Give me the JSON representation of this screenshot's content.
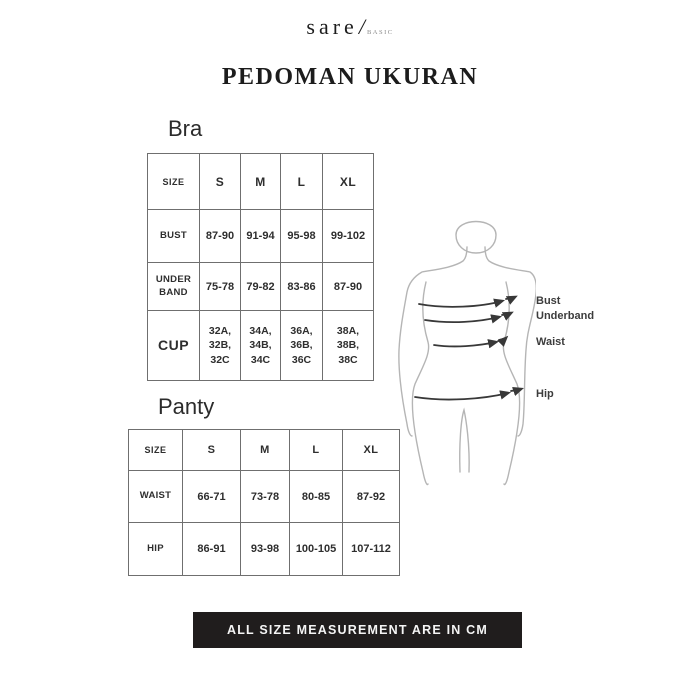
{
  "brand": {
    "name": "sare",
    "slash": "/",
    "sub": "BASIC"
  },
  "page": {
    "title": "PEDOMAN UKURAN"
  },
  "bra": {
    "heading": "Bra",
    "columns": [
      "SIZE",
      "S",
      "M",
      "L",
      "XL"
    ],
    "rows": [
      {
        "label": "BUST",
        "values": [
          "87-90",
          "91-94",
          "95-98",
          "99-102"
        ]
      },
      {
        "label": "UNDER\nBAND",
        "values": [
          "75-78",
          "79-82",
          "83-86",
          "87-90"
        ]
      },
      {
        "label": "CUP",
        "values": [
          "32A,\n32B,\n32C",
          "34A,\n34B,\n34C",
          "36A,\n36B,\n36C",
          "38A,\n38B,\n38C"
        ]
      }
    ]
  },
  "panty": {
    "heading": "Panty",
    "columns": [
      "SIZE",
      "S",
      "M",
      "L",
      "XL"
    ],
    "rows": [
      {
        "label": "WAIST",
        "values": [
          "66-71",
          "73-78",
          "80-85",
          "87-92"
        ]
      },
      {
        "label": "HIP",
        "values": [
          "86-91",
          "93-98",
          "100-105",
          "107-112"
        ]
      }
    ]
  },
  "diagram": {
    "labels": {
      "bust": "Bust",
      "underband": "Underband",
      "waist": "Waist",
      "hip": "Hip"
    }
  },
  "footer": {
    "note": "ALL SIZE MEASUREMENT ARE IN CM"
  },
  "colors": {
    "footer_bg": "#201d1d",
    "text": "#2e2e2e",
    "table_border": "#6f6f6f",
    "figure_outline": "#b5b5b5",
    "arrow": "#383838"
  }
}
